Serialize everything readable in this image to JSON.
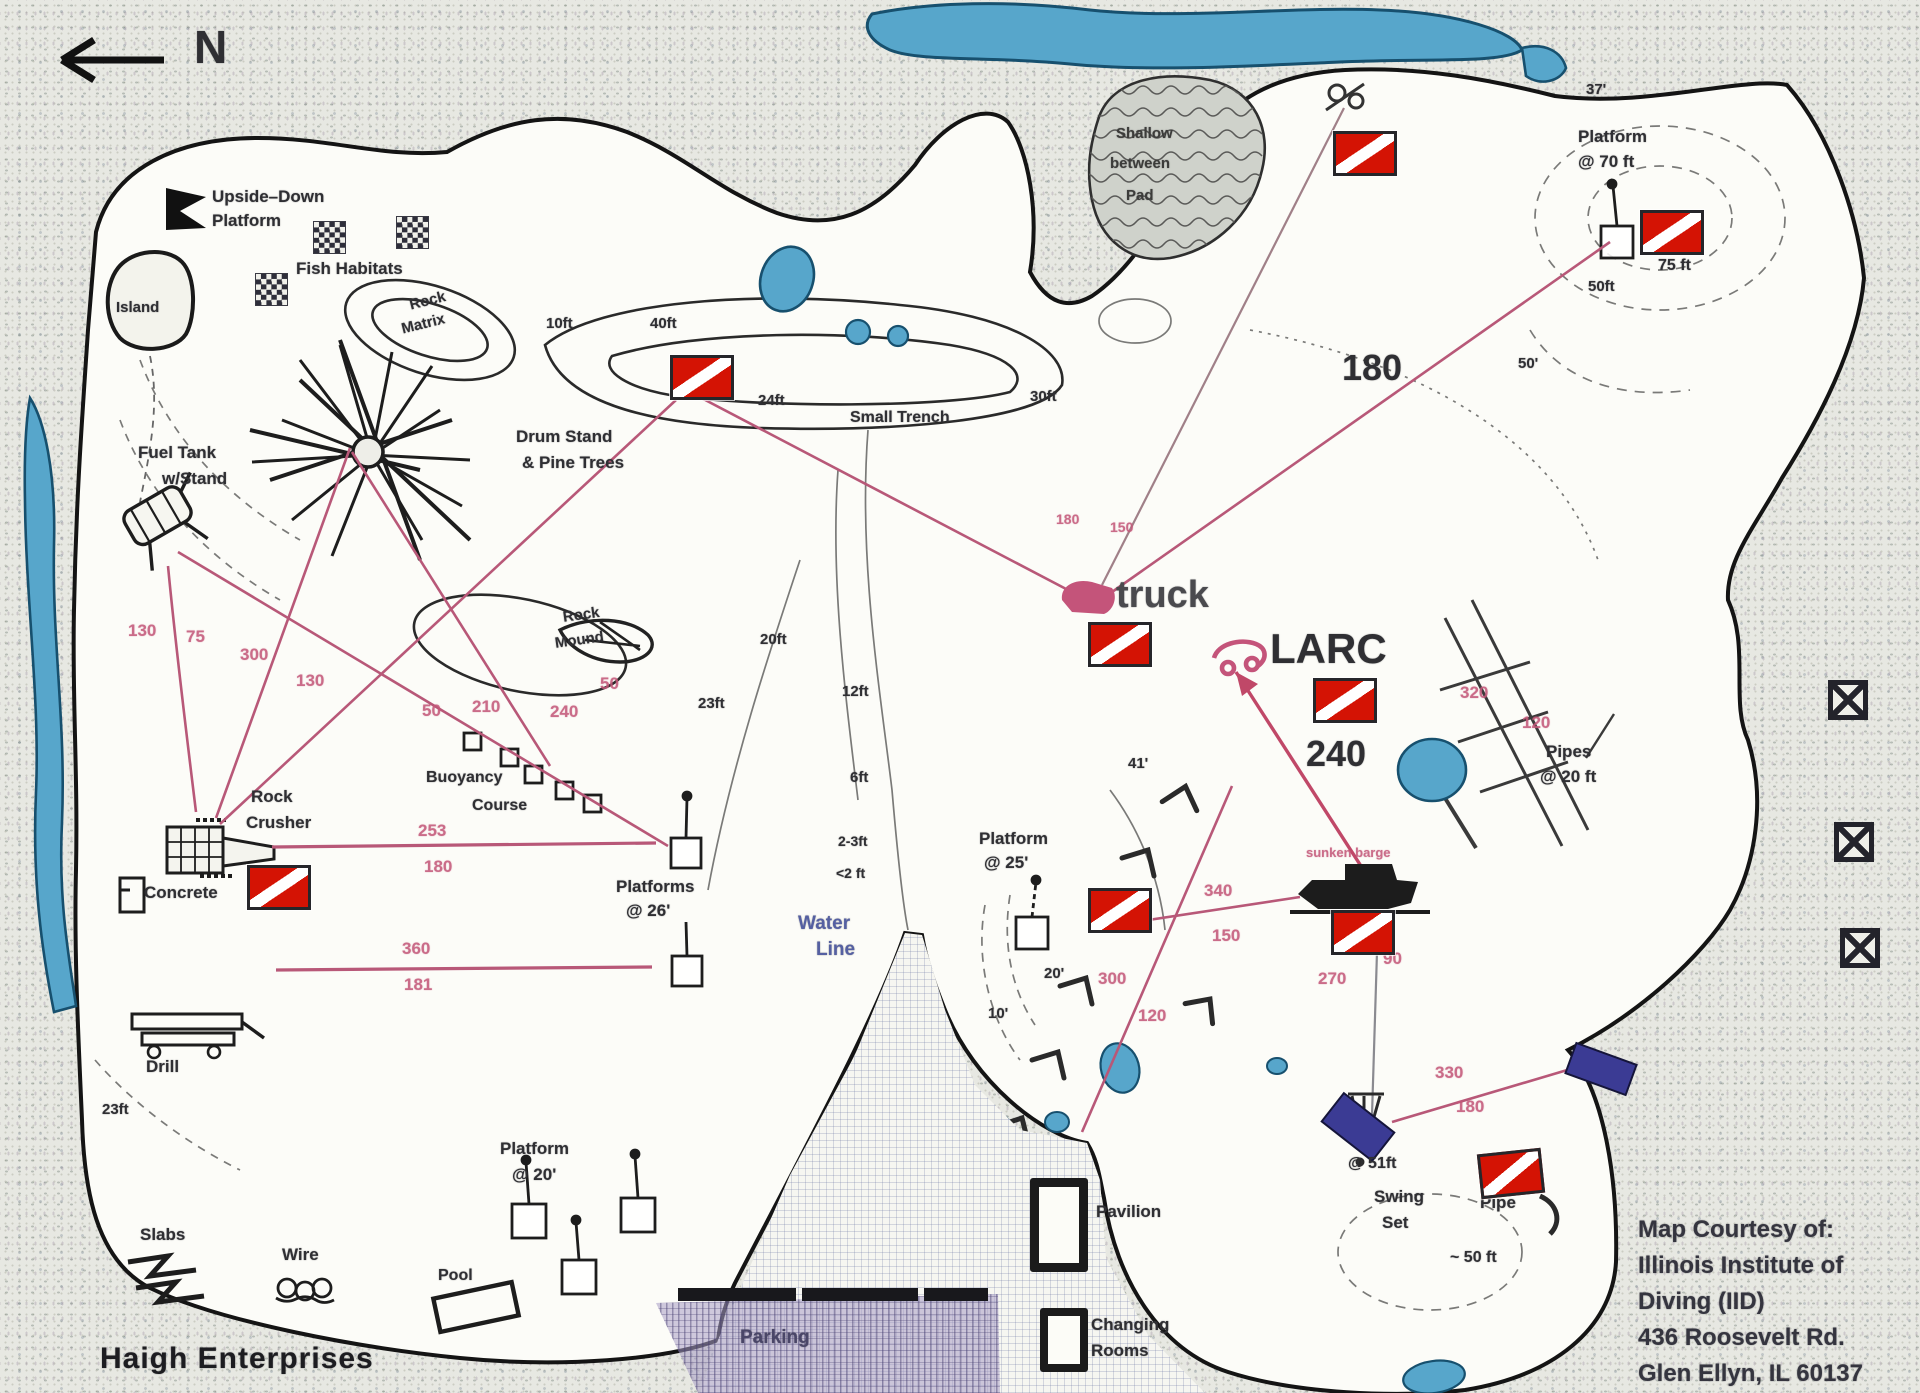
{
  "map": {
    "title": "Haigh Enterprises",
    "north_label": "N",
    "subtitle_note": "scanned dive-site map with dive flags and distance lines"
  },
  "credit": {
    "l1": "Map Courtesy of:",
    "l2": "Illinois Institute of",
    "l3": "Diving (IID)",
    "l4": "436 Roosevelt Rd.",
    "l5": "Glen Ellyn, IL 60137"
  },
  "colors": {
    "flag_red": "#d41304",
    "line_pink": "#b85878",
    "number_pink": "#c4597a",
    "water_blue": "#57a6cb",
    "label_blue": "#5560a2",
    "parking_purple": "#4a4668",
    "ink": "#2f2f33"
  },
  "labels": [
    {
      "n": "label-north",
      "t": "N",
      "x": 194,
      "y": 24,
      "s": 46
    },
    {
      "n": "label-upside-down-1",
      "t": "Upside–Down",
      "x": 212,
      "y": 188,
      "s": 17
    },
    {
      "n": "label-upside-down-2",
      "t": "Platform",
      "x": 212,
      "y": 212,
      "s": 17
    },
    {
      "n": "label-fish-habitats",
      "t": "Fish Habitats",
      "x": 296,
      "y": 260,
      "s": 17
    },
    {
      "n": "label-island",
      "t": "Island",
      "x": 116,
      "y": 300,
      "s": 15
    },
    {
      "n": "label-rock-matrix-1",
      "t": "Rock",
      "x": 408,
      "y": 298,
      "s": 15,
      "r": -14
    },
    {
      "n": "label-rock-matrix-2",
      "t": "Matrix",
      "x": 400,
      "y": 322,
      "s": 15,
      "r": -14
    },
    {
      "n": "label-drum-stand-1",
      "t": "Drum Stand",
      "x": 516,
      "y": 428,
      "s": 17
    },
    {
      "n": "label-drum-stand-2",
      "t": "& Pine Trees",
      "x": 522,
      "y": 454,
      "s": 17
    },
    {
      "n": "label-fuel-tank-1",
      "t": "Fuel Tank",
      "x": 138,
      "y": 444,
      "s": 17
    },
    {
      "n": "label-fuel-tank-2",
      "t": "w/Stand",
      "x": 162,
      "y": 470,
      "s": 17
    },
    {
      "n": "label-rock-mound-1",
      "t": "Rock",
      "x": 562,
      "y": 610,
      "s": 15,
      "r": -8
    },
    {
      "n": "label-rock-mound-2",
      "t": "Mound",
      "x": 554,
      "y": 636,
      "s": 15,
      "r": -8
    },
    {
      "n": "label-rock-crusher-1",
      "t": "Rock",
      "x": 251,
      "y": 788,
      "s": 17
    },
    {
      "n": "label-rock-crusher-2",
      "t": "Crusher",
      "x": 246,
      "y": 814,
      "s": 17
    },
    {
      "n": "label-concrete",
      "t": "Concrete",
      "x": 144,
      "y": 884,
      "s": 17
    },
    {
      "n": "label-buoyancy-1",
      "t": "Buoyancy",
      "x": 426,
      "y": 770,
      "s": 16
    },
    {
      "n": "label-buoyancy-2",
      "t": "Course",
      "x": 472,
      "y": 798,
      "s": 16
    },
    {
      "n": "label-platforms26-1",
      "t": "Platforms",
      "x": 616,
      "y": 878,
      "s": 17
    },
    {
      "n": "label-platforms26-2",
      "t": "@ 26'",
      "x": 626,
      "y": 902,
      "s": 17
    },
    {
      "n": "label-drill",
      "t": "Drill",
      "x": 146,
      "y": 1058,
      "s": 17
    },
    {
      "n": "label-slabs",
      "t": "Slabs",
      "x": 140,
      "y": 1226,
      "s": 17
    },
    {
      "n": "label-wire",
      "t": "Wire",
      "x": 282,
      "y": 1246,
      "s": 17
    },
    {
      "n": "label-pool",
      "t": "Pool",
      "x": 438,
      "y": 1268,
      "s": 16
    },
    {
      "n": "label-platform20-1",
      "t": "Platform",
      "x": 500,
      "y": 1140,
      "s": 17
    },
    {
      "n": "label-platform20-2",
      "t": "@ 20'",
      "x": 512,
      "y": 1166,
      "s": 17
    },
    {
      "n": "label-platform25-1",
      "t": "Platform",
      "x": 979,
      "y": 830,
      "s": 17
    },
    {
      "n": "label-platform25-2",
      "t": "@ 25'",
      "x": 984,
      "y": 854,
      "s": 17
    },
    {
      "n": "label-platform70-1",
      "t": "Platform",
      "x": 1578,
      "y": 128,
      "s": 17
    },
    {
      "n": "label-platform70-2",
      "t": "@ 70 ft",
      "x": 1578,
      "y": 153,
      "s": 17
    },
    {
      "n": "label-pipes-1",
      "t": "Pipes",
      "x": 1546,
      "y": 743,
      "s": 17
    },
    {
      "n": "label-pipes-2",
      "t": "@ 20 ft",
      "x": 1540,
      "y": 768,
      "s": 17
    },
    {
      "n": "label-swing-1",
      "t": "Swing",
      "x": 1374,
      "y": 1188,
      "s": 17
    },
    {
      "n": "label-swing-2",
      "t": "Set",
      "x": 1382,
      "y": 1214,
      "s": 17
    },
    {
      "n": "label-pipe",
      "t": "Pipe",
      "x": 1480,
      "y": 1194,
      "s": 17
    },
    {
      "n": "label-pavilion",
      "t": "Pavilion",
      "x": 1096,
      "y": 1203,
      "s": 17
    },
    {
      "n": "label-changing-1",
      "t": "Changing",
      "x": 1091,
      "y": 1316,
      "s": 17
    },
    {
      "n": "label-changing-2",
      "t": "Rooms",
      "x": 1091,
      "y": 1342,
      "s": 17
    },
    {
      "n": "label-pad-1",
      "t": "Shallow",
      "x": 1116,
      "y": 126,
      "s": 15,
      "c": "pad"
    },
    {
      "n": "label-pad-2",
      "t": "between",
      "x": 1110,
      "y": 156,
      "s": 15,
      "c": "pad"
    },
    {
      "n": "label-pad-3",
      "t": "Pad",
      "x": 1126,
      "y": 188,
      "s": 15,
      "c": "pad"
    },
    {
      "n": "label-barge",
      "t": "sunken barge",
      "x": 1306,
      "y": 846,
      "s": 13,
      "c": "pink"
    },
    {
      "n": "label-water-line-1",
      "t": "Water",
      "x": 798,
      "y": 914,
      "s": 19,
      "c": "blue"
    },
    {
      "n": "label-water-line-2",
      "t": "Line",
      "x": 816,
      "y": 940,
      "s": 19,
      "c": "blue"
    },
    {
      "n": "label-parking",
      "t": "Parking",
      "x": 740,
      "y": 1328,
      "s": 19,
      "c": "purple"
    },
    {
      "n": "label-truck",
      "t": "truck",
      "x": 1116,
      "y": 576,
      "s": 38,
      "c": "gray"
    },
    {
      "n": "label-larc",
      "t": "LARC",
      "x": 1270,
      "y": 628,
      "s": 42
    },
    {
      "n": "label-dist-180-big",
      "t": "180",
      "x": 1342,
      "y": 350,
      "s": 36
    },
    {
      "n": "label-dist-240-big",
      "t": "240",
      "x": 1306,
      "y": 736,
      "s": 36
    },
    {
      "n": "depth-10ft",
      "t": "10ft",
      "x": 546,
      "y": 316,
      "s": 15
    },
    {
      "n": "depth-40ft",
      "t": "40ft",
      "x": 650,
      "y": 316,
      "s": 15
    },
    {
      "n": "depth-24ft",
      "t": "24ft",
      "x": 758,
      "y": 393,
      "s": 15
    },
    {
      "n": "depth-30ft",
      "t": "30ft",
      "x": 1030,
      "y": 389,
      "s": 15
    },
    {
      "n": "label-small-trench",
      "t": "Small Trench",
      "x": 850,
      "y": 410,
      "s": 16
    },
    {
      "n": "depth-20ft",
      "t": "20ft",
      "x": 760,
      "y": 632,
      "s": 15
    },
    {
      "n": "depth-23ft",
      "t": "23ft",
      "x": 698,
      "y": 696,
      "s": 15
    },
    {
      "n": "depth-12ft",
      "t": "12ft",
      "x": 842,
      "y": 684,
      "s": 15
    },
    {
      "n": "depth-6ft",
      "t": "6ft",
      "x": 850,
      "y": 770,
      "s": 15
    },
    {
      "n": "depth-2-3ft",
      "t": "2-3ft",
      "x": 838,
      "y": 834,
      "s": 14
    },
    {
      "n": "depth-lt2ft",
      "t": "<2 ft",
      "x": 836,
      "y": 866,
      "s": 14
    },
    {
      "n": "depth-23ft-sw",
      "t": "23ft",
      "x": 102,
      "y": 1102,
      "s": 15
    },
    {
      "n": "depth-20q",
      "t": "20'",
      "x": 1044,
      "y": 966,
      "s": 15
    },
    {
      "n": "depth-10q",
      "t": "10'",
      "x": 988,
      "y": 1006,
      "s": 15
    },
    {
      "n": "depth-41q",
      "t": "41'",
      "x": 1128,
      "y": 756,
      "s": 15
    },
    {
      "n": "depth-37q",
      "t": "37'",
      "x": 1586,
      "y": 82,
      "s": 15
    },
    {
      "n": "depth-50ft-ne",
      "t": "50ft",
      "x": 1588,
      "y": 279,
      "s": 15
    },
    {
      "n": "depth-75ft",
      "t": "75 ft",
      "x": 1658,
      "y": 258,
      "s": 16
    },
    {
      "n": "depth-50q",
      "t": "50'",
      "x": 1518,
      "y": 356,
      "s": 15
    },
    {
      "n": "depth-51ft",
      "t": "@ 51ft",
      "x": 1348,
      "y": 1156,
      "s": 16
    },
    {
      "n": "depth-50ft-cove",
      "t": "~ 50 ft",
      "x": 1450,
      "y": 1250,
      "s": 16
    },
    {
      "n": "distance-130-a",
      "t": "130",
      "x": 128,
      "y": 622,
      "s": 17,
      "c": "pink"
    },
    {
      "n": "distance-75",
      "t": "75",
      "x": 186,
      "y": 628,
      "s": 17,
      "c": "pink"
    },
    {
      "n": "distance-300-a",
      "t": "300",
      "x": 240,
      "y": 646,
      "s": 17,
      "c": "pink"
    },
    {
      "n": "distance-130-b",
      "t": "130",
      "x": 296,
      "y": 672,
      "s": 17,
      "c": "pink"
    },
    {
      "n": "distance-50-a",
      "t": "50",
      "x": 422,
      "y": 702,
      "s": 17,
      "c": "pink"
    },
    {
      "n": "distance-210",
      "t": "210",
      "x": 472,
      "y": 698,
      "s": 17,
      "c": "pink"
    },
    {
      "n": "distance-240",
      "t": "240",
      "x": 550,
      "y": 703,
      "s": 17,
      "c": "pink"
    },
    {
      "n": "distance-50-b",
      "t": "50",
      "x": 600,
      "y": 675,
      "s": 17,
      "c": "pink"
    },
    {
      "n": "distance-253",
      "t": "253",
      "x": 418,
      "y": 822,
      "s": 17,
      "c": "pink"
    },
    {
      "n": "distance-180-a",
      "t": "180",
      "x": 424,
      "y": 858,
      "s": 17,
      "c": "pink"
    },
    {
      "n": "distance-360",
      "t": "360",
      "x": 402,
      "y": 940,
      "s": 17,
      "c": "pink"
    },
    {
      "n": "distance-181",
      "t": "181",
      "x": 404,
      "y": 976,
      "s": 17,
      "c": "pink"
    },
    {
      "n": "distance-180-truck",
      "t": "180",
      "x": 1056,
      "y": 512,
      "s": 14,
      "c": "pink"
    },
    {
      "n": "distance-150-truck",
      "t": "150",
      "x": 1110,
      "y": 520,
      "s": 14,
      "c": "pink"
    },
    {
      "n": "distance-340",
      "t": "340",
      "x": 1204,
      "y": 882,
      "s": 17,
      "c": "pink"
    },
    {
      "n": "distance-150",
      "t": "150",
      "x": 1212,
      "y": 927,
      "s": 17,
      "c": "pink"
    },
    {
      "n": "distance-300-b",
      "t": "300",
      "x": 1098,
      "y": 970,
      "s": 17,
      "c": "pink"
    },
    {
      "n": "distance-120-a",
      "t": "120",
      "x": 1138,
      "y": 1007,
      "s": 17,
      "c": "pink"
    },
    {
      "n": "distance-270",
      "t": "270",
      "x": 1318,
      "y": 970,
      "s": 17,
      "c": "pink"
    },
    {
      "n": "distance-90",
      "t": "90",
      "x": 1383,
      "y": 950,
      "s": 17,
      "c": "pink"
    },
    {
      "n": "distance-320",
      "t": "320",
      "x": 1460,
      "y": 684,
      "s": 17,
      "c": "pink"
    },
    {
      "n": "distance-120-b",
      "t": "120",
      "x": 1522,
      "y": 714,
      "s": 17,
      "c": "pink"
    },
    {
      "n": "distance-330",
      "t": "330",
      "x": 1435,
      "y": 1064,
      "s": 17,
      "c": "pink"
    },
    {
      "n": "distance-180-b",
      "t": "180",
      "x": 1456,
      "y": 1098,
      "s": 17,
      "c": "pink"
    }
  ],
  "flags": [
    {
      "n": "dive-flag-trench",
      "x": 670,
      "y": 355
    },
    {
      "n": "dive-flag-north-buoy",
      "x": 1333,
      "y": 131
    },
    {
      "n": "dive-flag-platform-70ft",
      "x": 1640,
      "y": 210
    },
    {
      "n": "dive-flag-truck",
      "x": 1088,
      "y": 622
    },
    {
      "n": "dive-flag-larc",
      "x": 1313,
      "y": 678
    },
    {
      "n": "dive-flag-rock-crusher",
      "x": 247,
      "y": 865
    },
    {
      "n": "dive-flag-platform-25ft",
      "x": 1088,
      "y": 888
    },
    {
      "n": "dive-flag-barge",
      "x": 1331,
      "y": 910
    },
    {
      "n": "dive-flag-pipe-cove",
      "x": 1479,
      "y": 1151,
      "r": -6
    }
  ],
  "checkers": [
    {
      "n": "fish-habitat-square-1",
      "x": 313,
      "y": 221
    },
    {
      "n": "fish-habitat-square-2",
      "x": 396,
      "y": 216
    },
    {
      "n": "fish-habitat-square-3",
      "x": 255,
      "y": 273
    }
  ],
  "xboxes": [
    {
      "n": "shore-marker-1",
      "x": 1828,
      "y": 680
    },
    {
      "n": "shore-marker-2",
      "x": 1834,
      "y": 822
    },
    {
      "n": "shore-marker-3",
      "x": 1840,
      "y": 928
    }
  ]
}
